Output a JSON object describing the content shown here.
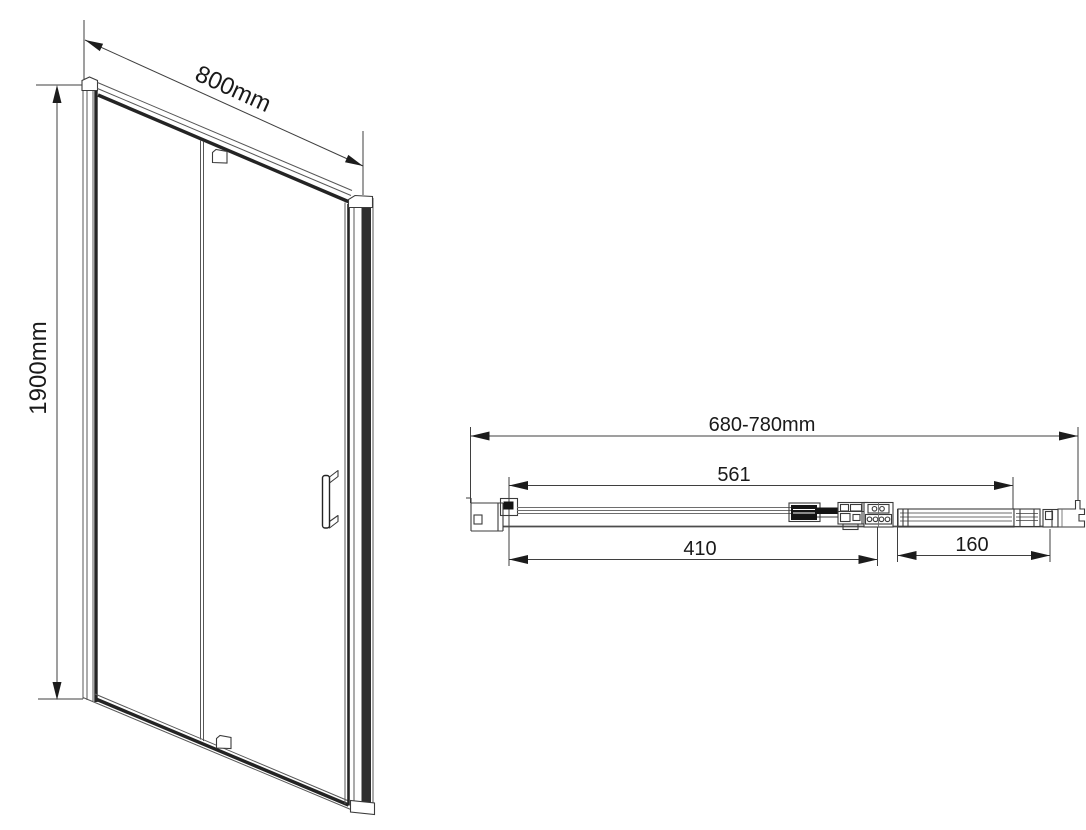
{
  "drawing": {
    "front_view": {
      "width_label": "800mm",
      "height_label": "1900mm"
    },
    "plan_view": {
      "overall_width_label": "680-780mm",
      "roller_span_label": "561",
      "door_panel_label": "410",
      "fixed_section_label": "160"
    },
    "colors": {
      "background": "#ffffff",
      "line": "#575757",
      "dark_line": "#242424",
      "text": "#1a1a1a"
    }
  }
}
